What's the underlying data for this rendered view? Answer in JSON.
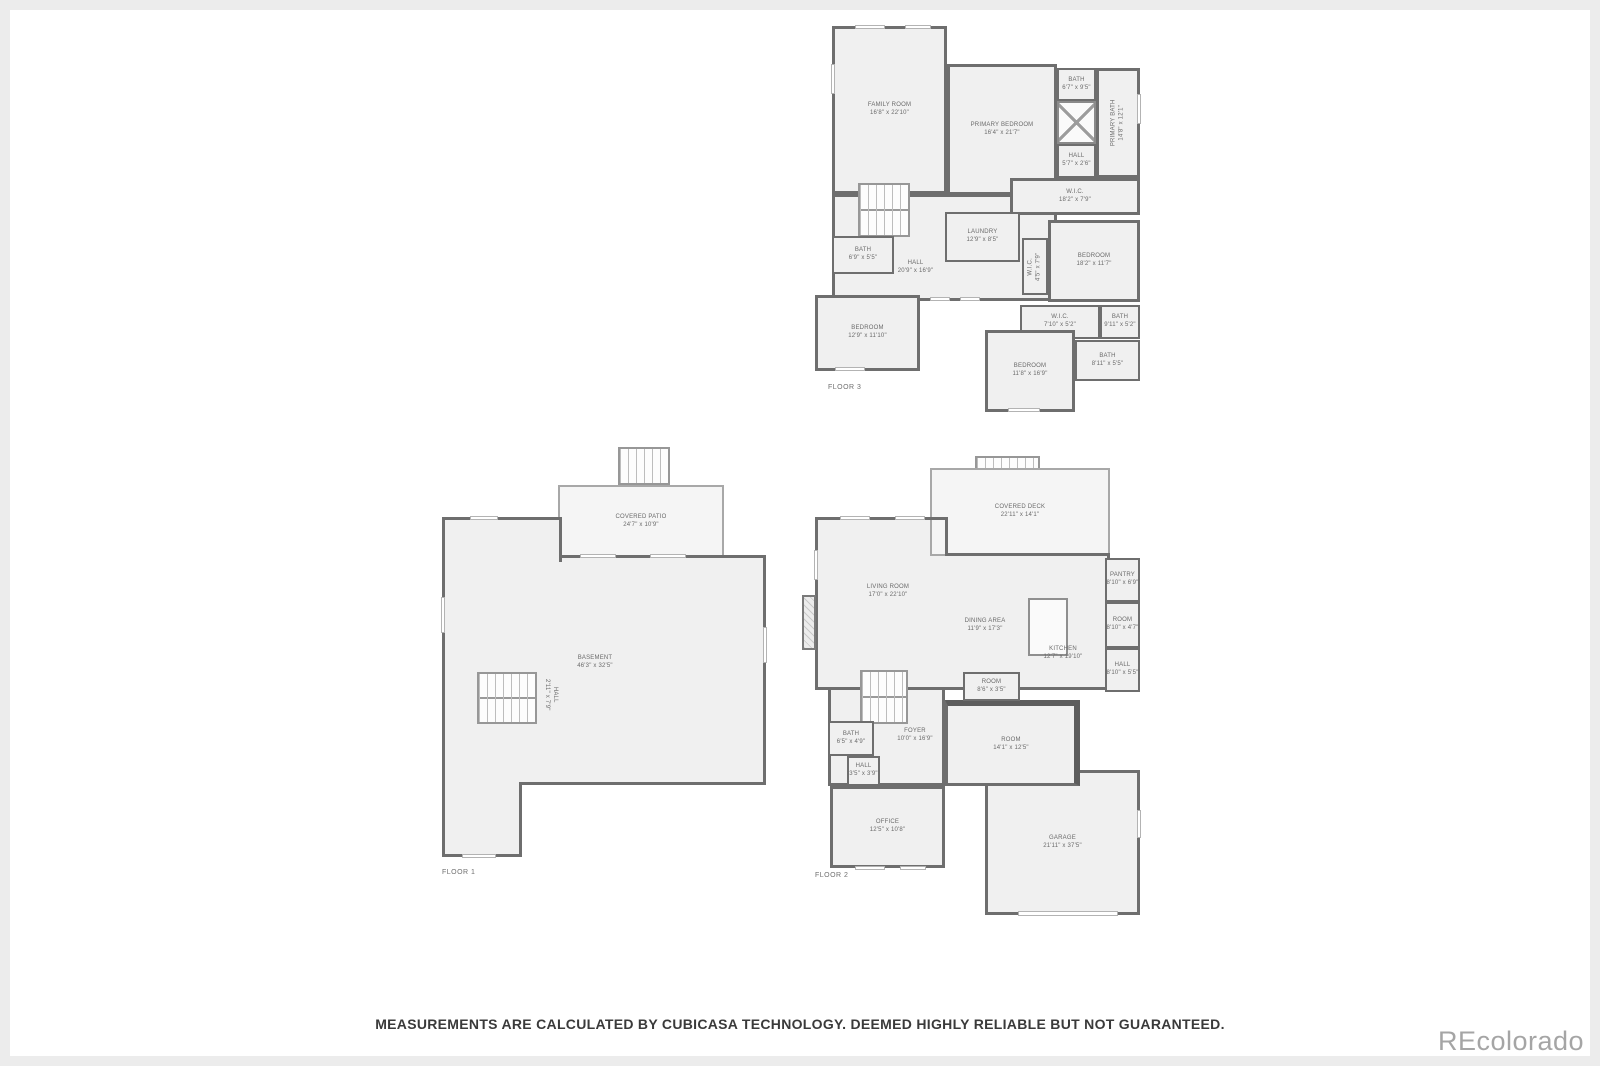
{
  "page": {
    "disclaimer": "MEASUREMENTS ARE CALCULATED BY CUBICASA TECHNOLOGY. DEEMED HIGHLY RELIABLE BUT NOT GUARANTEED.",
    "watermark": "REcolorado"
  },
  "floors": {
    "floor1": {
      "label": "FLOOR 1",
      "rooms": {
        "covered_patio": {
          "name": "COVERED PATIO",
          "dims": "24'7\" x 10'9\""
        },
        "basement": {
          "name": "BASEMENT",
          "dims": "46'3\" x 32'5\""
        },
        "hall": {
          "name": "HALL",
          "dims": "2'11\" x 7'9\""
        }
      }
    },
    "floor2": {
      "label": "FLOOR 2",
      "rooms": {
        "covered_deck": {
          "name": "COVERED DECK",
          "dims": "22'11\" x 14'1\""
        },
        "living_room": {
          "name": "LIVING ROOM",
          "dims": "17'0\" x 22'10\""
        },
        "dining_area": {
          "name": "DINING AREA",
          "dims": "11'9\" x 17'3\""
        },
        "kitchen": {
          "name": "KITCHEN",
          "dims": "12'7\" x 19'10\""
        },
        "pantry": {
          "name": "PANTRY",
          "dims": "8'10\" x 6'9\""
        },
        "room_right": {
          "name": "ROOM",
          "dims": "8'10\" x 4'7\""
        },
        "hall_right": {
          "name": "HALL",
          "dims": "8'10\" x 5'5\""
        },
        "room_small": {
          "name": "ROOM",
          "dims": "8'6\" x 3'5\""
        },
        "foyer": {
          "name": "FOYER",
          "dims": "10'0\" x 16'9\""
        },
        "bath": {
          "name": "BATH",
          "dims": "6'5\" x 4'9\""
        },
        "hall_left": {
          "name": "HALL",
          "dims": "3'5\" x 3'9\""
        },
        "office": {
          "name": "OFFICE",
          "dims": "12'5\" x 10'8\""
        },
        "room_center": {
          "name": "ROOM",
          "dims": "14'1\" x 12'5\""
        },
        "garage": {
          "name": "GARAGE",
          "dims": "21'11\" x 37'5\""
        }
      }
    },
    "floor3": {
      "label": "FLOOR 3",
      "rooms": {
        "family_room": {
          "name": "FAMILY ROOM",
          "dims": "16'8\" x 22'10\""
        },
        "primary_bedroom": {
          "name": "PRIMARY BEDROOM",
          "dims": "16'4\" x 21'7\""
        },
        "bath_top": {
          "name": "BATH",
          "dims": "6'7\" x 9'5\""
        },
        "primary_bath": {
          "name": "PRIMARY BATH",
          "dims": "14'8\" x 12'1\""
        },
        "hall_small": {
          "name": "HALL",
          "dims": "5'7\" x 2'6\""
        },
        "wic_long": {
          "name": "W.I.C.",
          "dims": "18'2\" x 7'9\""
        },
        "laundry": {
          "name": "LAUNDRY",
          "dims": "12'9\" x 8'5\""
        },
        "bath_left": {
          "name": "BATH",
          "dims": "6'9\" x 5'5\""
        },
        "hall_main": {
          "name": "HALL",
          "dims": "20'9\" x 16'9\""
        },
        "wic_small": {
          "name": "W.I.C.",
          "dims": "4'5\" x 7'9\""
        },
        "bedroom_right": {
          "name": "BEDROOM",
          "dims": "18'2\" x 11'7\""
        },
        "bedroom_left": {
          "name": "BEDROOM",
          "dims": "12'9\" x 11'10\""
        },
        "wic_bottom": {
          "name": "W.I.C.",
          "dims": "7'10\" x 5'2\""
        },
        "bath_right_upper": {
          "name": "BATH",
          "dims": "9'11\" x 5'2\""
        },
        "bedroom_bottom": {
          "name": "BEDROOM",
          "dims": "11'8\" x 16'9\""
        },
        "bath_right_lower": {
          "name": "BATH",
          "dims": "8'11\" x 5'5\""
        }
      }
    }
  }
}
